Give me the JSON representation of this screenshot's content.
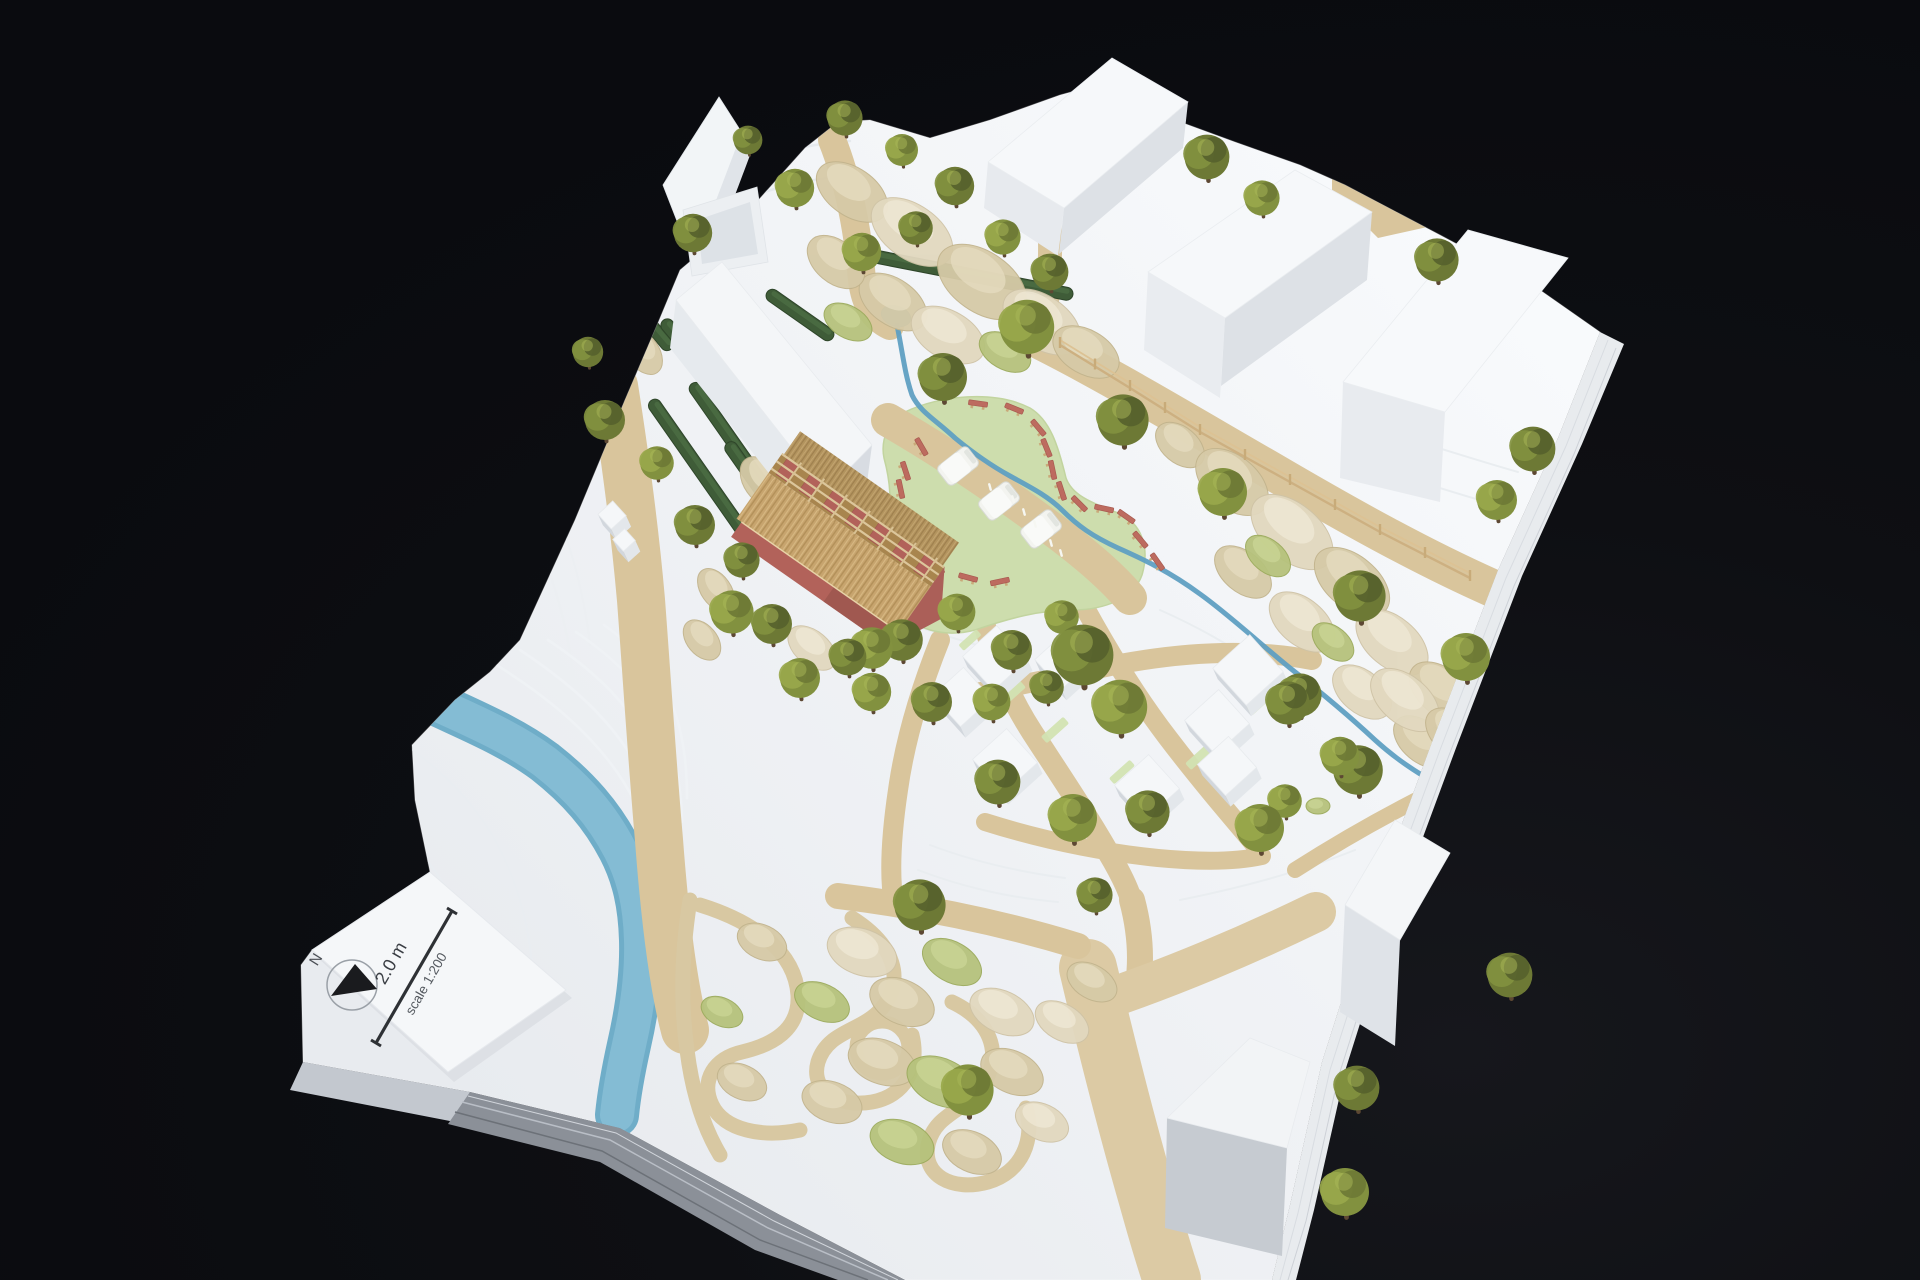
{
  "scene": {
    "description": "Photograph of a white architectural site model on a black background: massing buildings, model trees, a blue river with terraced banks, tan footpaths, a central green meadow with benches and food trucks, a thatched-roof hall and a winding garden, with a printed north-arrow scale card",
    "background": "#0b0c10"
  },
  "scale_card": {
    "north_label": "N",
    "bar_label": "2.0 m",
    "scale_label": "scale 1:200"
  },
  "palette": {
    "background": "#0b0c10",
    "board_light": "#f8fafc",
    "board_shade": "#e8ebef",
    "path_tan": "#d9c59c",
    "meadow_green": "#cdddad",
    "river_blue": "#84bcd4",
    "stream_blue": "#5f9fc2",
    "tree_greens": [
      "#55602c",
      "#6d7935",
      "#82913f",
      "#99a84b"
    ],
    "trunk_brown": "#5d4833",
    "lichen": [
      "#d6caa7",
      "#e2d8bf",
      "#b6c27c"
    ],
    "hedge_green": "#3f5c38",
    "bench_red": "#bd6b5f",
    "thatch": "#c7a46e",
    "hut_wall_red": "#b2625a",
    "card_white": "#f5f7f9",
    "ink": "#2e3135"
  },
  "model": {
    "trees": [
      [
        845,
        118,
        22,
        1
      ],
      [
        902,
        150,
        20,
        2
      ],
      [
        955,
        186,
        24,
        1
      ],
      [
        1003,
        237,
        22,
        2
      ],
      [
        1050,
        272,
        23,
        1
      ],
      [
        862,
        252,
        24,
        2
      ],
      [
        916,
        228,
        21,
        1
      ],
      [
        795,
        188,
        24,
        2
      ],
      [
        748,
        140,
        18,
        1
      ],
      [
        693,
        233,
        24,
        1
      ],
      [
        1207,
        157,
        28,
        1
      ],
      [
        1262,
        198,
        22,
        2
      ],
      [
        1437,
        260,
        27,
        1
      ],
      [
        1533,
        449,
        28,
        1
      ],
      [
        1497,
        500,
        25,
        2
      ],
      [
        1223,
        492,
        30,
        2
      ],
      [
        1360,
        596,
        32,
        1
      ],
      [
        1466,
        657,
        30,
        2
      ],
      [
        1300,
        695,
        27,
        1
      ],
      [
        1358,
        770,
        31,
        1
      ],
      [
        1285,
        801,
        21,
        2
      ],
      [
        943,
        377,
        30,
        1
      ],
      [
        1027,
        327,
        34,
        2
      ],
      [
        1123,
        420,
        32,
        1
      ],
      [
        902,
        640,
        26,
        1
      ],
      [
        957,
        612,
        23,
        2
      ],
      [
        1012,
        650,
        25,
        1
      ],
      [
        1062,
        617,
        21,
        2
      ],
      [
        872,
        692,
        24,
        2
      ],
      [
        932,
        702,
        25,
        1
      ],
      [
        992,
        702,
        23,
        2
      ],
      [
        1047,
        687,
        21,
        1
      ],
      [
        588,
        352,
        19,
        1
      ],
      [
        605,
        420,
        25,
        1
      ],
      [
        657,
        463,
        21,
        2
      ],
      [
        695,
        525,
        25,
        1
      ],
      [
        732,
        612,
        27,
        2
      ],
      [
        772,
        624,
        25,
        1
      ],
      [
        742,
        560,
        22,
        1
      ],
      [
        872,
        648,
        26,
        2
      ],
      [
        800,
        678,
        25,
        2
      ],
      [
        848,
        657,
        23,
        1
      ],
      [
        1083,
        655,
        38,
        1
      ],
      [
        1120,
        707,
        34,
        2
      ],
      [
        998,
        782,
        28,
        1
      ],
      [
        1073,
        818,
        30,
        2
      ],
      [
        1148,
        812,
        27,
        1
      ],
      [
        1260,
        828,
        30,
        2
      ],
      [
        1288,
        703,
        27,
        1
      ],
      [
        1340,
        756,
        24,
        2
      ],
      [
        920,
        905,
        32,
        1
      ],
      [
        968,
        1090,
        32,
        2
      ],
      [
        1095,
        895,
        22,
        1
      ],
      [
        1357,
        1088,
        28,
        1
      ],
      [
        1345,
        1192,
        30,
        2
      ],
      [
        1510,
        975,
        28,
        1
      ]
    ],
    "lichen": [
      [
        852,
        192,
        40,
        24,
        35,
        0
      ],
      [
        912,
        232,
        46,
        27,
        35,
        1
      ],
      [
        982,
        282,
        50,
        30,
        35,
        0
      ],
      [
        1042,
        322,
        44,
        26,
        35,
        1
      ],
      [
        893,
        302,
        38,
        23,
        35,
        0
      ],
      [
        948,
        335,
        40,
        24,
        30,
        1
      ],
      [
        836,
        262,
        33,
        21,
        40,
        0
      ],
      [
        1086,
        352,
        36,
        22,
        30,
        0
      ],
      [
        848,
        322,
        26,
        16,
        30,
        2
      ],
      [
        1005,
        352,
        28,
        17,
        30,
        2
      ],
      [
        1180,
        445,
        28,
        18,
        40,
        0
      ],
      [
        1232,
        482,
        42,
        26,
        40,
        0
      ],
      [
        1292,
        532,
        48,
        28,
        40,
        1
      ],
      [
        1352,
        582,
        44,
        26,
        40,
        0
      ],
      [
        1302,
        622,
        38,
        23,
        40,
        1
      ],
      [
        1243,
        572,
        33,
        20,
        40,
        0
      ],
      [
        1392,
        642,
        42,
        25,
        40,
        1
      ],
      [
        1442,
        692,
        38,
        23,
        40,
        0
      ],
      [
        1362,
        692,
        34,
        21,
        40,
        1
      ],
      [
        1422,
        742,
        33,
        20,
        40,
        0
      ],
      [
        1268,
        556,
        26,
        16,
        40,
        2
      ],
      [
        1333,
        642,
        24,
        15,
        40,
        2
      ],
      [
        1405,
        700,
        40,
        24,
        40,
        1
      ],
      [
        1455,
        735,
        34,
        21,
        40,
        0
      ],
      [
        1318,
        806,
        12,
        8,
        0,
        2
      ],
      [
        716,
        590,
        24,
        15,
        55,
        0
      ],
      [
        812,
        648,
        28,
        17,
        40,
        1
      ],
      [
        702,
        640,
        23,
        15,
        50,
        0
      ],
      [
        762,
        482,
        28,
        18,
        55,
        0
      ],
      [
        643,
        352,
        25,
        16,
        55,
        0
      ],
      [
        577,
        332,
        21,
        13,
        55,
        1
      ],
      [
        862,
        952,
        36,
        23,
        20,
        1
      ],
      [
        902,
        1002,
        34,
        22,
        25,
        0
      ],
      [
        952,
        962,
        32,
        20,
        30,
        2
      ],
      [
        1002,
        1012,
        34,
        21,
        25,
        1
      ],
      [
        882,
        1062,
        35,
        22,
        20,
        0
      ],
      [
        942,
        1082,
        37,
        23,
        25,
        2
      ],
      [
        1012,
        1072,
        33,
        21,
        25,
        0
      ],
      [
        1062,
        1022,
        29,
        18,
        30,
        1
      ],
      [
        832,
        1102,
        31,
        20,
        20,
        0
      ],
      [
        902,
        1142,
        33,
        21,
        20,
        2
      ],
      [
        972,
        1152,
        31,
        20,
        25,
        0
      ],
      [
        1042,
        1122,
        28,
        18,
        25,
        1
      ],
      [
        1092,
        982,
        27,
        17,
        30,
        0
      ],
      [
        822,
        1002,
        29,
        18,
        25,
        2
      ],
      [
        762,
        942,
        26,
        17,
        25,
        0
      ],
      [
        742,
        1082,
        26,
        17,
        25,
        0
      ],
      [
        722,
        1012,
        22,
        14,
        25,
        2
      ]
    ],
    "hedges": [
      [
        700,
        470,
        170,
        55
      ],
      [
        735,
        445,
        150,
        55
      ],
      [
        762,
        492,
        120,
        55
      ],
      [
        585,
        290,
        110,
        55
      ],
      [
        620,
        265,
        100,
        55
      ],
      [
        960,
        273,
        230,
        11
      ],
      [
        800,
        315,
        80,
        35
      ],
      [
        655,
        330,
        50,
        50
      ],
      [
        678,
        338,
        46,
        50
      ]
    ],
    "benches": [
      [
        978,
        404,
        8
      ],
      [
        1014,
        409,
        22
      ],
      [
        1038,
        428,
        50
      ],
      [
        1046,
        448,
        68
      ],
      [
        1052,
        470,
        78
      ],
      [
        1061,
        491,
        72
      ],
      [
        1079,
        504,
        45
      ],
      [
        1104,
        509,
        12
      ],
      [
        1126,
        517,
        35
      ],
      [
        921,
        447,
        60
      ],
      [
        905,
        471,
        72
      ],
      [
        900,
        489,
        78
      ],
      [
        913,
        541,
        82
      ],
      [
        937,
        566,
        55
      ],
      [
        968,
        578,
        15
      ],
      [
        1000,
        582,
        -12
      ],
      [
        1140,
        540,
        50
      ],
      [
        1157,
        562,
        55
      ]
    ],
    "food_trucks": [
      [
        958,
        466,
        -38
      ],
      [
        999,
        501,
        -38
      ],
      [
        1041,
        529,
        -38
      ]
    ],
    "figures": [
      [
        1013,
        499
      ],
      [
        1024,
        512
      ],
      [
        1035,
        524
      ],
      [
        1051,
        543
      ],
      [
        1061,
        553
      ],
      [
        990,
        487
      ]
    ],
    "fence_points": [
      [
        1060,
        345
      ],
      [
        1130,
        388
      ],
      [
        1200,
        432
      ],
      [
        1290,
        482
      ],
      [
        1380,
        532
      ],
      [
        1470,
        578
      ]
    ],
    "village_cubes": [
      [
        995,
        658,
        46
      ],
      [
        962,
        697,
        42
      ],
      [
        1005,
        761,
        46
      ],
      [
        1063,
        661,
        40
      ],
      [
        1248,
        670,
        50
      ],
      [
        1217,
        722,
        46
      ],
      [
        1227,
        766,
        42
      ],
      [
        1147,
        787,
        46
      ],
      [
        612,
        515,
        20
      ],
      [
        624,
        540,
        16
      ]
    ],
    "green_strips": [
      [
        1010,
        695,
        34,
        10
      ],
      [
        1055,
        730,
        30,
        9
      ],
      [
        1262,
        700,
        36,
        10
      ],
      [
        1200,
        756,
        32,
        9
      ],
      [
        1122,
        772,
        28,
        8
      ],
      [
        970,
        640,
        24,
        8
      ]
    ]
  }
}
